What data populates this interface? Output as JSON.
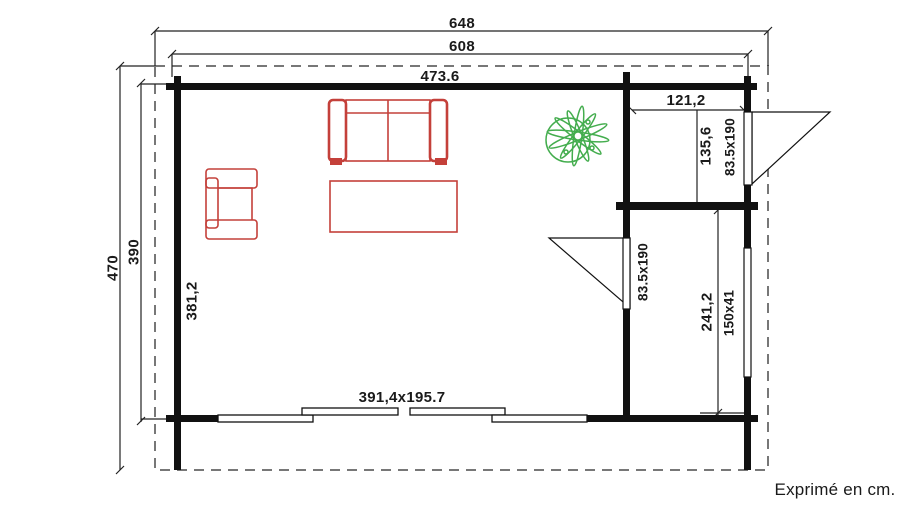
{
  "meta": {
    "title": "Garden cabin floor plan",
    "unit_note": "Exprimé en cm.",
    "units": "cm"
  },
  "dimensions": {
    "roof_width": "648",
    "building_width": "608",
    "main_room_width": "473.6",
    "annex_width": "121,2",
    "annex_top_depth": "135,6",
    "annex_top_door": "83.5x190",
    "annex_bottom_depth": "241,2",
    "annex_bottom_window": "150x41",
    "interior_door": "83.5x190",
    "roof_depth": "470",
    "building_depth": "390",
    "main_room_depth": "381,2",
    "front_sliding_door": "391,4x195.7"
  },
  "rooms": [
    {
      "name": "main room",
      "width_cm": "473.6",
      "depth_cm": "381,2"
    },
    {
      "name": "annex top right",
      "width_cm": "121,2",
      "depth_cm": "135,6"
    },
    {
      "name": "annex bottom right",
      "width_cm": "121,2",
      "depth_cm": "241,2"
    }
  ],
  "openings": [
    {
      "type": "exterior door",
      "size": "83.5x190",
      "location": "right wall, top annex"
    },
    {
      "type": "interior door",
      "size": "83.5x190",
      "location": "partition wall to main room"
    },
    {
      "type": "window",
      "size": "150x41",
      "location": "right wall, bottom annex"
    },
    {
      "type": "sliding door",
      "size": "391,4x195.7",
      "location": "front wall"
    }
  ],
  "furniture": [
    {
      "name": "sofa",
      "color": "#c4403a"
    },
    {
      "name": "armchair",
      "color": "#c4403a"
    },
    {
      "name": "coffee-table",
      "color": "#c4403a"
    },
    {
      "name": "plant",
      "color": "#44ad4e"
    }
  ],
  "colors": {
    "walls": "#111111",
    "dimension_lines": "#222222",
    "roof_outline_dashed": "#777777",
    "furniture_red": "#c4403a",
    "plant_green": "#44ad4e",
    "background": "#ffffff"
  }
}
